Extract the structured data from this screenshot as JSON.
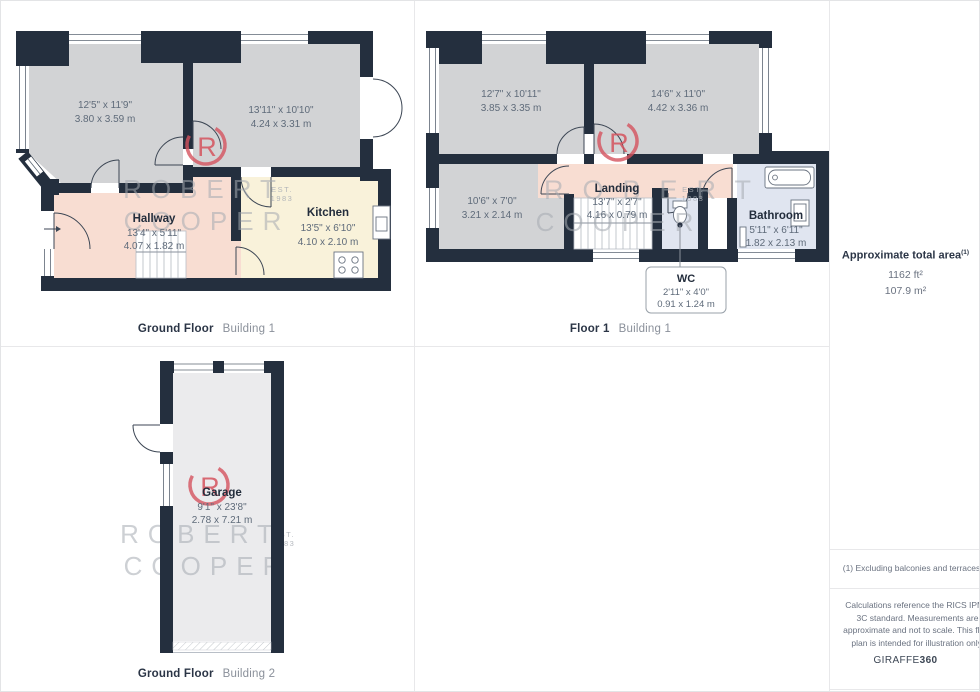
{
  "watermark": {
    "logo_letter": "R",
    "line1": "ROBERT",
    "line2": "COOPER",
    "est": "EST.",
    "year": "1983"
  },
  "plans": {
    "ground1": {
      "label_bold": "Ground Floor",
      "label_light": "Building 1",
      "rooms": {
        "reception1": {
          "imperial": "12'5\" x 11'9\"",
          "metric": "3.80 x 3.59 m"
        },
        "reception2": {
          "imperial": "13'11\" x 10'10\"",
          "metric": "4.24 x 3.31 m"
        },
        "hallway": {
          "name": "Hallway",
          "imperial": "13'4\" x 5'11\"",
          "metric": "4.07 x 1.82 m"
        },
        "kitchen": {
          "name": "Kitchen",
          "imperial": "13'5\" x 6'10\"",
          "metric": "4.10 x 2.10 m"
        }
      }
    },
    "floor1": {
      "label_bold": "Floor 1",
      "label_light": "Building 1",
      "rooms": {
        "bedroom1": {
          "imperial": "12'7\" x 10'11\"",
          "metric": "3.85 x 3.35 m"
        },
        "bedroom2": {
          "imperial": "14'6\" x 11'0\"",
          "metric": "4.42 x 3.36 m"
        },
        "bedroom3": {
          "imperial": "10'6\" x 7'0\"",
          "metric": "3.21 x 2.14 m"
        },
        "landing": {
          "name": "Landing",
          "imperial": "13'7\" x 2'7\"",
          "metric": "4.16 x 0.79 m"
        },
        "bathroom": {
          "name": "Bathroom",
          "imperial": "5'11\" x 6'11\"",
          "metric": "1.82 x 2.13 m"
        },
        "wc": {
          "name": "WC",
          "imperial": "2'11\" x 4'0\"",
          "metric": "0.91 x 1.24 m"
        }
      }
    },
    "ground2": {
      "label_bold": "Ground Floor",
      "label_light": "Building 2",
      "rooms": {
        "garage": {
          "name": "Garage",
          "imperial": "9'1\" x 23'8\"",
          "metric": "2.78 x 7.21 m"
        }
      }
    }
  },
  "sidebar": {
    "area_title": "Approximate total area",
    "area_sup": "(1)",
    "area_ft": "1162 ft²",
    "area_m": "107.9 m²",
    "footnote": "(1) Excluding balconies and terraces",
    "disclaimer": "Calculations reference the RICS IPMS 3C standard. Measurements are approximate and not to scale. This floor plan is intended for illustration only.",
    "brand_name": "GIRAFFE",
    "brand_suffix": "360"
  },
  "colors": {
    "wall": "#242f3e",
    "room_gray": "#d2d3d5",
    "hall_salmon": "#f8ddd2",
    "kitchen_cream": "#f9f2da",
    "bath_lavender": "#e0e5f0",
    "garage_gray": "#ebebed",
    "logo_red": "#d5535e"
  }
}
